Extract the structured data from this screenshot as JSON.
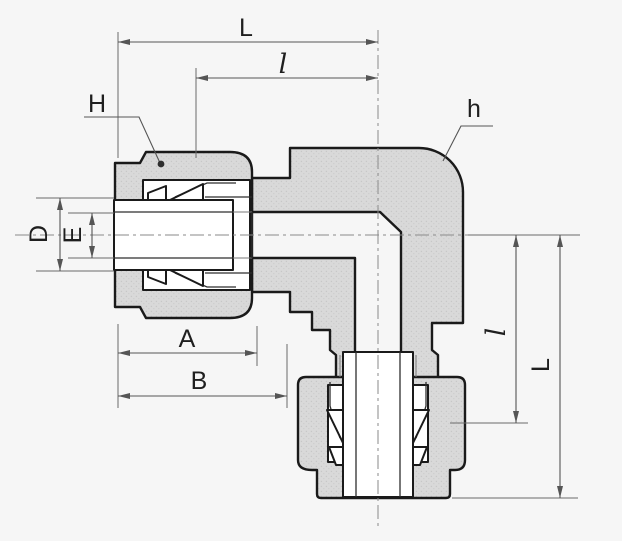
{
  "figure": {
    "type": "technical-drawing",
    "subject": "90-degree elbow compression tube fitting, sectional view with dimension callouts",
    "labels": {
      "L_top": "L",
      "l_top": "l",
      "H_left": "H",
      "h_right": "h",
      "D_left": "D",
      "E_left": "E",
      "A_bottom": "A",
      "B_bottom": "B",
      "l_right": "l",
      "L_right": "L"
    },
    "colors": {
      "background": "#f6f6f6",
      "metal_fill": "#d9d9d9",
      "metal_texture_dot": "#c6c6c6",
      "outline": "#1a1a1a",
      "dimension_line": "#555555",
      "centerline": "#8a8a8a",
      "label_text": "#1f1f1f"
    }
  }
}
